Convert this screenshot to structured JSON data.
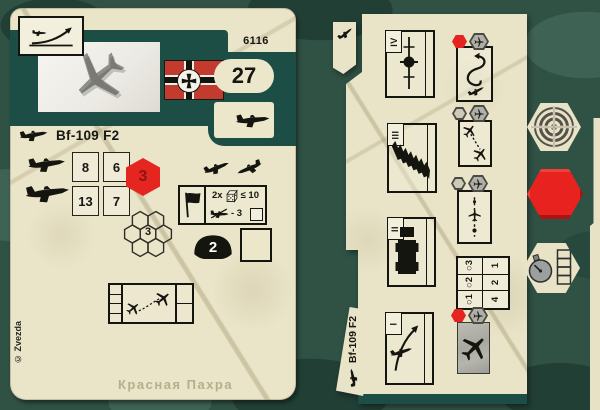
{
  "colors": {
    "teal_band": "#1d4e46",
    "card_cream": "#e9e3c8",
    "accent_red": "#e52420",
    "camo_base": "#305245",
    "flag_red": "#c23b2e"
  },
  "left_card": {
    "set_number": "6116",
    "cost": "27",
    "title": "Bf-109 F2",
    "stats": {
      "rows": [
        [
          "8",
          "6"
        ],
        [
          "13",
          "7"
        ]
      ]
    },
    "initiative_hex": "3",
    "cluster_value": "3",
    "defense_value": "2",
    "attack": {
      "multiplier": "2x",
      "threshold": "≤ 10",
      "modifier": "- 3"
    },
    "copyright": "© Zvezda",
    "map_label": "Красная Пахра"
  },
  "right_card": {
    "title": "Bf-109 F2",
    "sections": [
      {
        "numeral": "IV"
      },
      {
        "numeral": "III"
      },
      {
        "numeral": "II"
      },
      {
        "numeral": "I"
      }
    ],
    "range_table": {
      "rows": [
        [
          "○3",
          "1"
        ],
        [
          "○2",
          "2"
        ],
        [
          "○1",
          "4"
        ]
      ]
    }
  },
  "icons": {
    "left_card": [
      "takeoff-icon",
      "aircraft-photo",
      "war-flag",
      "fighter-silhouette",
      "dice-icon",
      "black-flag",
      "crossed-plane",
      "helmet",
      "hex-cluster",
      "pursuit-diagram"
    ],
    "right_card": [
      "level-flight-icon",
      "rocket-salvo-icon",
      "truck-icon",
      "takeoff-icon",
      "loop-maneuver",
      "attack-maneuver",
      "bomb-run",
      "plane-photo"
    ],
    "tokens": [
      "target-token",
      "red-hex-token",
      "stopwatch-token"
    ]
  }
}
